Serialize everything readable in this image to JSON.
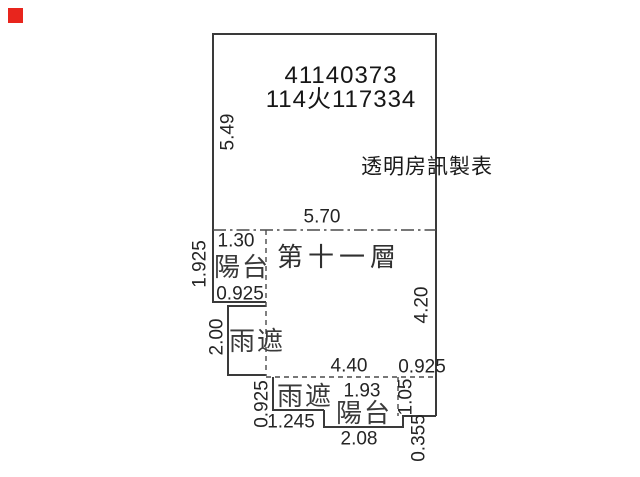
{
  "marker": {
    "style": "background:#e8251d"
  },
  "colors": {
    "marker_red": "#e8251d",
    "line_ink": "#3a3a3a",
    "text_ink": "#1e1e1e"
  },
  "header": {
    "doc_number_line1": "41140373",
    "doc_number_line2": "114火117334",
    "credit": "透明房訊製表"
  },
  "plan": {
    "floor_label": "第十一層",
    "rooms": {
      "balcony_top": "陽台",
      "canopy_left": "雨遮",
      "canopy_bottom": "雨遮",
      "balcony_bottom": "陽台"
    },
    "dimensions": {
      "left_height": "5.49",
      "top_width": "5.70",
      "balcony_top_width": "1.30",
      "balcony_top_height": "1.925",
      "balcony_top_bottom_width": "0.925",
      "canopy_left_height": "2.00",
      "right_height": "4.20",
      "bottom_width": "4.40",
      "bottom_right_width": "0.925",
      "canopy_bottom_height": "0.925",
      "balcony_bottom_inner_width": "1.93",
      "balcony_bottom_right_height": "1.05",
      "canopy_bottom_width": "1.245",
      "balcony_bottom_width": "2.08",
      "bottom_step_height": "0.355"
    }
  }
}
